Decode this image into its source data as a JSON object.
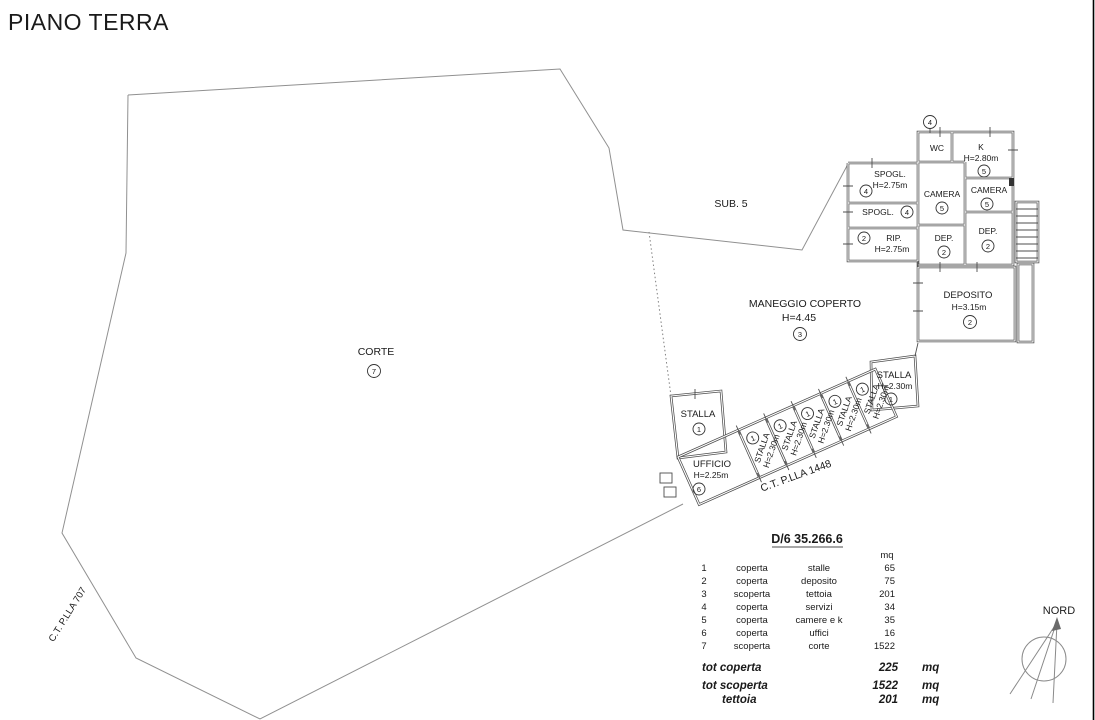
{
  "title": "PIANO TERRA",
  "colors": {
    "wall_line": "#4d4d4d",
    "boundary_line": "#909090",
    "text": "#1a1a1a"
  },
  "areas": {
    "sub5": {
      "label": "SUB. 5"
    },
    "corte": {
      "label": "CORTE",
      "num": "7"
    },
    "maneggio": {
      "label": "MANEGGIO COPERTO",
      "height": "H=4.45",
      "num": "3"
    }
  },
  "parcels": {
    "p1448": {
      "label": "C.T. P.LLA 1448"
    },
    "p707": {
      "label": "C.T. P.LLA 707"
    }
  },
  "rooms": {
    "num_top": {
      "num": "4"
    },
    "wc": {
      "label": "WC"
    },
    "k": {
      "label": "K",
      "height": "H=2.80m",
      "num": "5"
    },
    "spogl1": {
      "label": "SPOGL.",
      "height": "H=2.75m",
      "num": "4"
    },
    "spogl2": {
      "label": "SPOGL.",
      "num": "4"
    },
    "rip": {
      "label": "RIP.",
      "height": "H=2.75m",
      "num": "2"
    },
    "camera1": {
      "label": "CAMERA",
      "num": "5"
    },
    "camera2": {
      "label": "CAMERA",
      "num": "5"
    },
    "dep1": {
      "label": "DEP.",
      "num": "2"
    },
    "dep2": {
      "label": "DEP.",
      "num": "2"
    },
    "deposito": {
      "label": "DEPOSITO",
      "height": "H=3.15m",
      "num": "2"
    },
    "stalla_corner": {
      "label": "STALLA",
      "num": "1"
    },
    "ufficio": {
      "label": "UFFICIO",
      "height": "H=2.25m",
      "num": "6"
    },
    "stalla_row": {
      "label": "STALLA",
      "height": "H=2.30m",
      "num": "1"
    },
    "stalla_end": {
      "label": "STALLA",
      "height": "H=2.30m",
      "num": "1"
    }
  },
  "legend": {
    "title": "D/6 35.266.6",
    "unit_header": "mq",
    "rows": [
      {
        "n": "1",
        "cover": "coperta",
        "name": "stalle",
        "mq": "65"
      },
      {
        "n": "2",
        "cover": "coperta",
        "name": "deposito",
        "mq": "75"
      },
      {
        "n": "3",
        "cover": "scoperta",
        "name": "tettoia",
        "mq": "201"
      },
      {
        "n": "4",
        "cover": "coperta",
        "name": "servizi",
        "mq": "34"
      },
      {
        "n": "5",
        "cover": "coperta",
        "name": "camere e k",
        "mq": "35"
      },
      {
        "n": "6",
        "cover": "coperta",
        "name": "uffici",
        "mq": "16"
      },
      {
        "n": "7",
        "cover": "scoperta",
        "name": "corte",
        "mq": "1522"
      }
    ],
    "totals": [
      {
        "label": "tot coperta",
        "value": "225",
        "unit": "mq"
      },
      {
        "label": "tot scoperta",
        "value": "1522",
        "unit": "mq"
      },
      {
        "label": "tettoia",
        "value": "201",
        "unit": "mq"
      }
    ]
  },
  "compass": {
    "label": "NORD"
  }
}
